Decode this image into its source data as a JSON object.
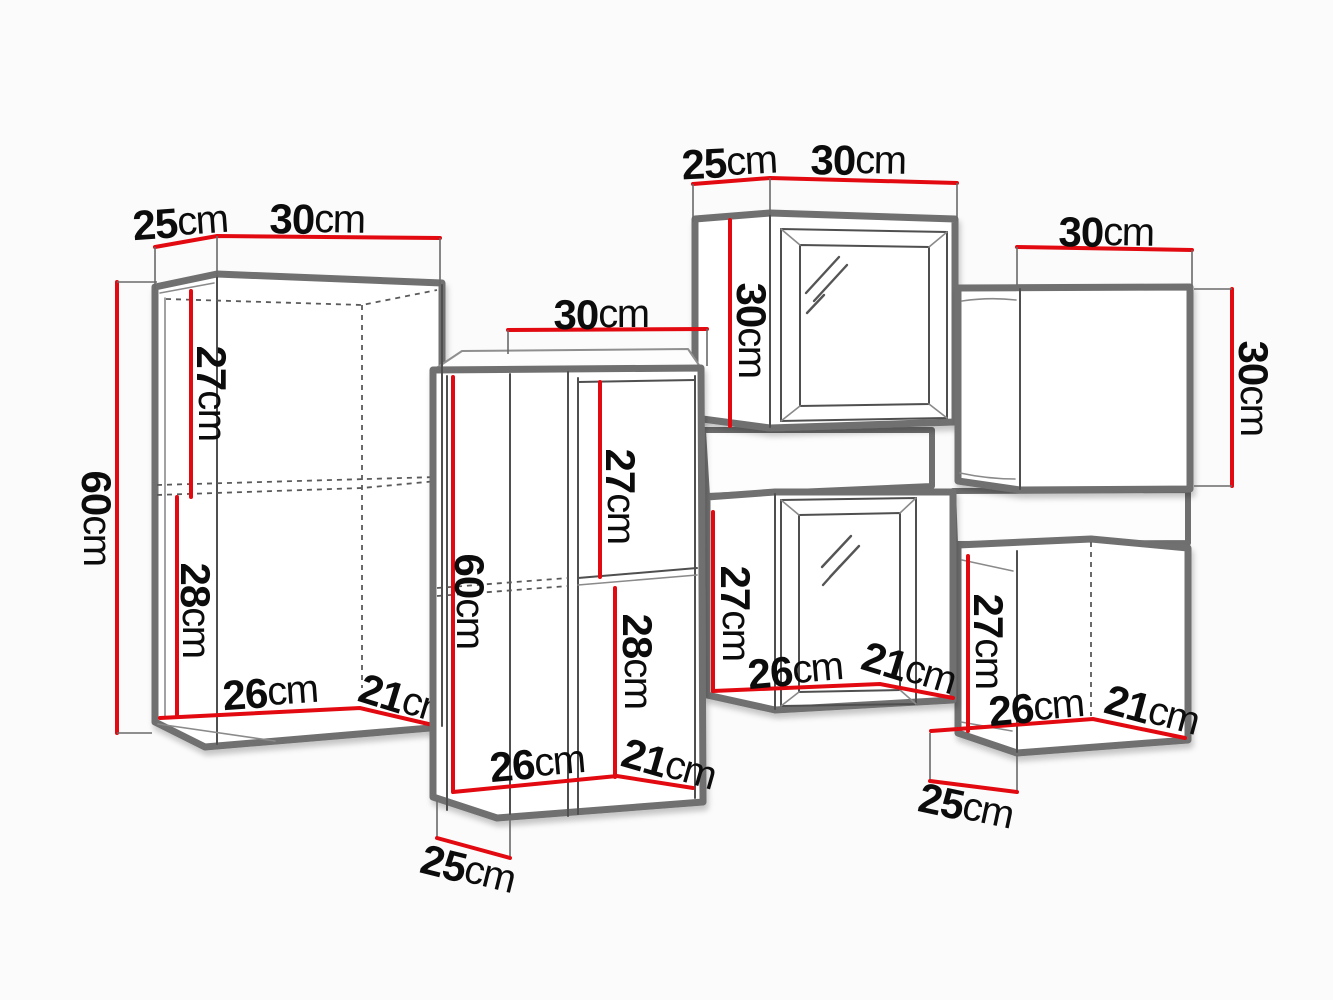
{
  "diagram": {
    "kind": "furniture-dimension-diagram",
    "colors": {
      "background": "#fbfbfb",
      "cabinet_outline": "#6f6f6f",
      "dimension_line": "#e20a10",
      "label_text": "#0c0c0c"
    }
  },
  "cabinets": [
    {
      "name": "tall-cabinet-left",
      "labels": {
        "top_depth": {
          "value": "25",
          "unit": "cm"
        },
        "top_width": {
          "value": "30",
          "unit": "cm"
        },
        "height": {
          "value": "60",
          "unit": "cm"
        },
        "upper": {
          "value": "27",
          "unit": "cm"
        },
        "lower": {
          "value": "28",
          "unit": "cm"
        },
        "bottom_width": {
          "value": "26",
          "unit": "cm"
        },
        "bottom_depth": {
          "value": "21",
          "unit": "cm"
        }
      }
    },
    {
      "name": "tall-shelf-cabinet-middle",
      "labels": {
        "top_width": {
          "value": "30",
          "unit": "cm"
        },
        "height": {
          "value": "60",
          "unit": "cm"
        },
        "upper": {
          "value": "27",
          "unit": "cm"
        },
        "lower": {
          "value": "28",
          "unit": "cm"
        },
        "bottom_width": {
          "value": "26",
          "unit": "cm"
        },
        "bottom_depth": {
          "value": "21",
          "unit": "cm"
        },
        "base_depth": {
          "value": "25",
          "unit": "cm"
        }
      }
    },
    {
      "name": "glass-door-cabinet-top-middle",
      "labels": {
        "top_depth": {
          "value": "25",
          "unit": "cm"
        },
        "top_width": {
          "value": "30",
          "unit": "cm"
        },
        "height": {
          "value": "30",
          "unit": "cm"
        }
      }
    },
    {
      "name": "square-cabinet-top-right",
      "labels": {
        "top_width": {
          "value": "30",
          "unit": "cm"
        },
        "height": {
          "value": "30",
          "unit": "cm"
        }
      }
    },
    {
      "name": "glass-door-cabinet-middle-right",
      "labels": {
        "height": {
          "value": "27",
          "unit": "cm"
        },
        "bottom_width": {
          "value": "26",
          "unit": "cm"
        },
        "bottom_depth": {
          "value": "21",
          "unit": "cm"
        }
      }
    },
    {
      "name": "square-cabinet-bottom-right",
      "labels": {
        "height": {
          "value": "27",
          "unit": "cm"
        },
        "bottom_width": {
          "value": "26",
          "unit": "cm"
        },
        "bottom_depth": {
          "value": "21",
          "unit": "cm"
        },
        "base_depth": {
          "value": "25",
          "unit": "cm"
        }
      }
    }
  ]
}
